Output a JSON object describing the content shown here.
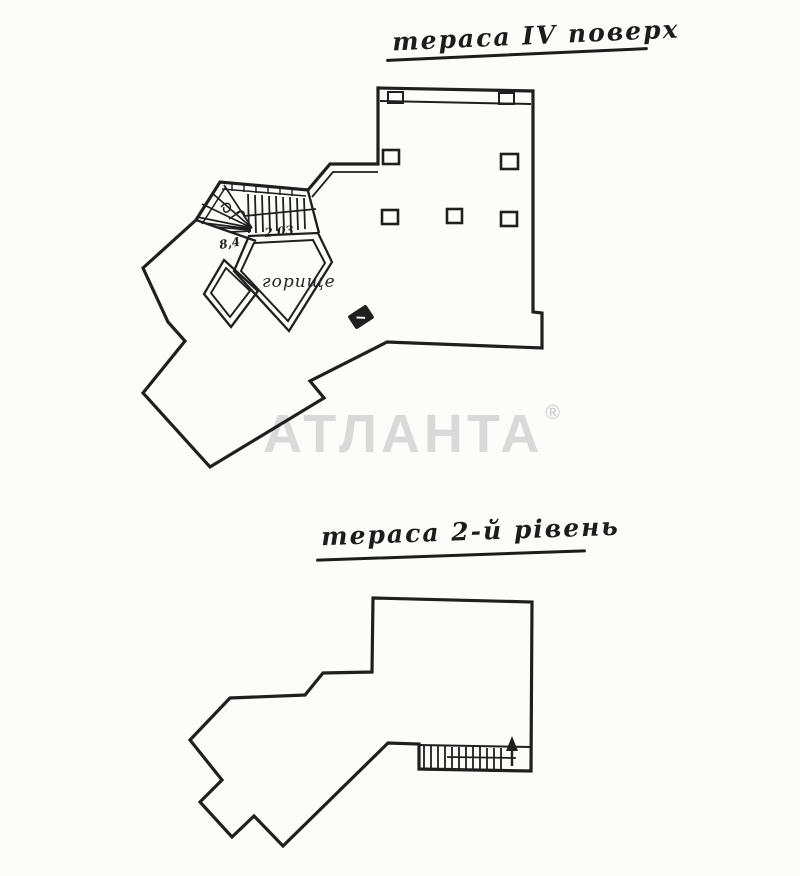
{
  "page": {
    "background_color": "#fcfcfb",
    "ink_color": "#1f1f1f"
  },
  "titles": {
    "upper": "тераса ІV поверх",
    "lower": "тераса 2-й рівень"
  },
  "watermark": {
    "text": "АТЛАНТА",
    "registered_mark": "®",
    "color": "#d9d9d9"
  },
  "upper_plan": {
    "labels": {
      "attic": "горище",
      "stair_dimension": "2.03",
      "stair_area": "8,4"
    }
  },
  "lower_plan": {
    "labels": {}
  }
}
